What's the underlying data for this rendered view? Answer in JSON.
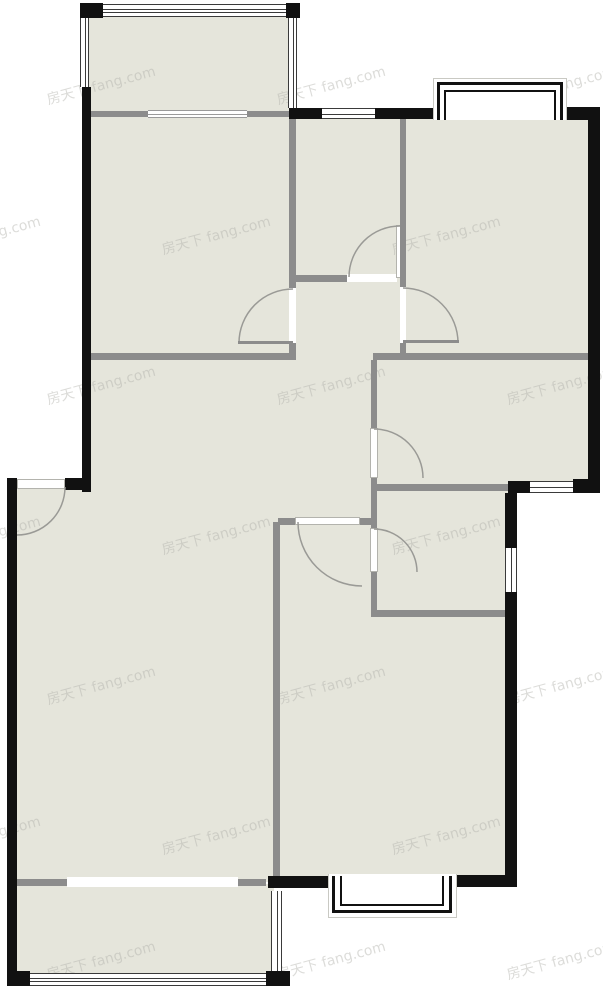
{
  "meta": {
    "type": "residential-floor-plan",
    "canvas": {
      "width": 603,
      "height": 989
    }
  },
  "watermark": {
    "text": "房天下 fang.com",
    "rotation_deg": -15,
    "font_size_px": 14,
    "color": "#b2b2ac",
    "opacity": 0.45,
    "rows_y": [
      75,
      225,
      375,
      525,
      675,
      825,
      950
    ],
    "cols_x": [
      45,
      275,
      505
    ],
    "odd_row_x_shift": -115
  },
  "colors": {
    "floor": "#e5e5db",
    "wall_exterior": "#111111",
    "wall_interior": "#8c8c8c",
    "door_arc": "#9a9a96",
    "window_line": "#3a3a3a",
    "window_line_light": "#9a9a9a",
    "panel_border": "#b3b3ad",
    "bay_halo": "#c9c9c3",
    "white": "#ffffff"
  },
  "floors": [
    {
      "x": 86,
      "y": 15,
      "w": 206,
      "h": 100
    },
    {
      "x": 88,
      "y": 112,
      "w": 205,
      "h": 248
    },
    {
      "x": 293,
      "y": 118,
      "w": 110,
      "h": 240
    },
    {
      "x": 403,
      "y": 118,
      "w": 187,
      "h": 240
    },
    {
      "x": 373,
      "y": 358,
      "w": 217,
      "h": 128
    },
    {
      "x": 373,
      "y": 486,
      "w": 135,
      "h": 128
    },
    {
      "x": 88,
      "y": 357,
      "w": 290,
      "h": 165
    },
    {
      "x": 16,
      "y": 482,
      "w": 362,
      "h": 400
    },
    {
      "x": 280,
      "y": 614,
      "w": 228,
      "h": 265
    },
    {
      "x": 16,
      "y": 884,
      "w": 258,
      "h": 92
    }
  ],
  "walls_exterior": [
    {
      "x": 80,
      "y": 3,
      "w": 23,
      "h": 15
    },
    {
      "x": 286,
      "y": 3,
      "w": 14,
      "h": 15
    },
    {
      "x": 82,
      "y": 87,
      "w": 9,
      "h": 405
    },
    {
      "x": 289,
      "y": 108,
      "w": 33,
      "h": 11
    },
    {
      "x": 375,
      "y": 108,
      "w": 63,
      "h": 11
    },
    {
      "x": 562,
      "y": 107,
      "w": 38,
      "h": 13
    },
    {
      "x": 588,
      "y": 108,
      "w": 12,
      "h": 385
    },
    {
      "x": 573,
      "y": 479,
      "w": 27,
      "h": 14
    },
    {
      "x": 508,
      "y": 481,
      "w": 22,
      "h": 12
    },
    {
      "x": 505,
      "y": 493,
      "w": 12,
      "h": 55
    },
    {
      "x": 505,
      "y": 592,
      "w": 12,
      "h": 295
    },
    {
      "x": 268,
      "y": 876,
      "w": 65,
      "h": 12
    },
    {
      "x": 452,
      "y": 875,
      "w": 65,
      "h": 12
    },
    {
      "x": 7,
      "y": 478,
      "w": 10,
      "h": 507
    },
    {
      "x": 65,
      "y": 478,
      "w": 26,
      "h": 12
    },
    {
      "x": 7,
      "y": 971,
      "w": 23,
      "h": 15
    },
    {
      "x": 266,
      "y": 971,
      "w": 24,
      "h": 15
    }
  ],
  "walls_interior": [
    {
      "x": 88,
      "y": 111,
      "w": 60,
      "h": 6
    },
    {
      "x": 247,
      "y": 111,
      "w": 45,
      "h": 6
    },
    {
      "x": 86,
      "y": 353,
      "w": 209,
      "h": 7
    },
    {
      "x": 289,
      "y": 115,
      "w": 7,
      "h": 173
    },
    {
      "x": 289,
      "y": 343,
      "w": 7,
      "h": 17
    },
    {
      "x": 293,
      "y": 275,
      "w": 54,
      "h": 7
    },
    {
      "x": 400,
      "y": 118,
      "w": 6,
      "h": 169
    },
    {
      "x": 400,
      "y": 343,
      "w": 6,
      "h": 15
    },
    {
      "x": 373,
      "y": 353,
      "w": 217,
      "h": 7
    },
    {
      "x": 371,
      "y": 360,
      "w": 6,
      "h": 68
    },
    {
      "x": 371,
      "y": 478,
      "w": 6,
      "h": 50
    },
    {
      "x": 371,
      "y": 572,
      "w": 6,
      "h": 45
    },
    {
      "x": 375,
      "y": 484,
      "w": 133,
      "h": 7
    },
    {
      "x": 371,
      "y": 610,
      "w": 137,
      "h": 7
    },
    {
      "x": 278,
      "y": 518,
      "w": 17,
      "h": 7
    },
    {
      "x": 360,
      "y": 518,
      "w": 12,
      "h": 7
    },
    {
      "x": 273,
      "y": 522,
      "w": 7,
      "h": 360
    },
    {
      "x": 16,
      "y": 879,
      "w": 51,
      "h": 7
    },
    {
      "x": 238,
      "y": 879,
      "w": 28,
      "h": 7
    }
  ],
  "openings": [
    {
      "x": 289,
      "y": 288,
      "w": 7,
      "h": 55
    },
    {
      "x": 347,
      "y": 274,
      "w": 50,
      "h": 8
    },
    {
      "x": 400,
      "y": 287,
      "w": 6,
      "h": 56
    },
    {
      "x": 67,
      "y": 877,
      "w": 171,
      "h": 10
    }
  ],
  "door_panels": [
    {
      "x": 370,
      "y": 428,
      "w": 8,
      "h": 50
    },
    {
      "x": 370,
      "y": 528,
      "w": 8,
      "h": 44
    },
    {
      "x": 295,
      "y": 517,
      "w": 65,
      "h": 8
    },
    {
      "x": 17,
      "y": 479,
      "w": 48,
      "h": 10
    },
    {
      "x": 396,
      "y": 225,
      "w": 8,
      "h": 53
    }
  ],
  "windows": [
    {
      "x": 103,
      "y": 4,
      "w": 183,
      "h": 13,
      "o": "h",
      "lines": 4,
      "light": false
    },
    {
      "x": 80,
      "y": 17,
      "w": 9,
      "h": 70,
      "o": "v",
      "lines": 3,
      "light": false
    },
    {
      "x": 288,
      "y": 16,
      "w": 9,
      "h": 92,
      "o": "v",
      "lines": 3,
      "light": false
    },
    {
      "x": 148,
      "y": 110,
      "w": 99,
      "h": 8,
      "o": "h",
      "lines": 3,
      "light": true
    },
    {
      "x": 322,
      "y": 108,
      "w": 53,
      "h": 11,
      "o": "h",
      "lines": 3,
      "light": false
    },
    {
      "x": 530,
      "y": 481,
      "w": 45,
      "h": 12,
      "o": "h",
      "lines": 3,
      "light": false
    },
    {
      "x": 505,
      "y": 548,
      "w": 12,
      "h": 44,
      "o": "v",
      "lines": 3,
      "light": false
    },
    {
      "x": 23,
      "y": 973,
      "w": 244,
      "h": 13,
      "o": "h",
      "lines": 4,
      "light": false
    },
    {
      "x": 271,
      "y": 891,
      "w": 11,
      "h": 82,
      "o": "v",
      "lines": 3,
      "light": false
    }
  ],
  "bay_windows": [
    {
      "halo": {
        "x": 433,
        "y": 78,
        "w": 134,
        "h": 42
      },
      "outer": {
        "x": 437,
        "y": 82,
        "w": 126,
        "h": 38
      },
      "inner": {
        "x": 444,
        "y": 90,
        "w": 112,
        "h": 30
      },
      "open_side": "bottom"
    },
    {
      "halo": {
        "x": 328,
        "y": 874,
        "w": 129,
        "h": 44
      },
      "outer": {
        "x": 332,
        "y": 876,
        "w": 120,
        "h": 37
      },
      "inner": {
        "x": 340,
        "y": 876,
        "w": 104,
        "h": 30
      },
      "open_side": "top"
    }
  ],
  "door_arcs": [
    {
      "cx": 293,
      "cy": 343,
      "r": 54,
      "a0": 180,
      "a1": 270
    },
    {
      "cx": 400,
      "cy": 277,
      "r": 51,
      "a0": 180,
      "a1": 270
    },
    {
      "cx": 403,
      "cy": 343,
      "r": 55,
      "a0": 270,
      "a1": 360
    },
    {
      "cx": 374,
      "cy": 478,
      "r": 49,
      "a0": 270,
      "a1": 360
    },
    {
      "cx": 374,
      "cy": 572,
      "r": 43,
      "a0": 270,
      "a1": 360
    },
    {
      "cx": 362,
      "cy": 522,
      "r": 64,
      "a0": 90,
      "a1": 180
    },
    {
      "cx": 17,
      "cy": 487,
      "r": 48,
      "a0": 0,
      "a1": 90
    }
  ],
  "door_leaves": [
    {
      "x": 238,
      "y": 341,
      "w": 55,
      "h": 3
    },
    {
      "x": 403,
      "y": 340,
      "w": 56,
      "h": 3
    }
  ]
}
